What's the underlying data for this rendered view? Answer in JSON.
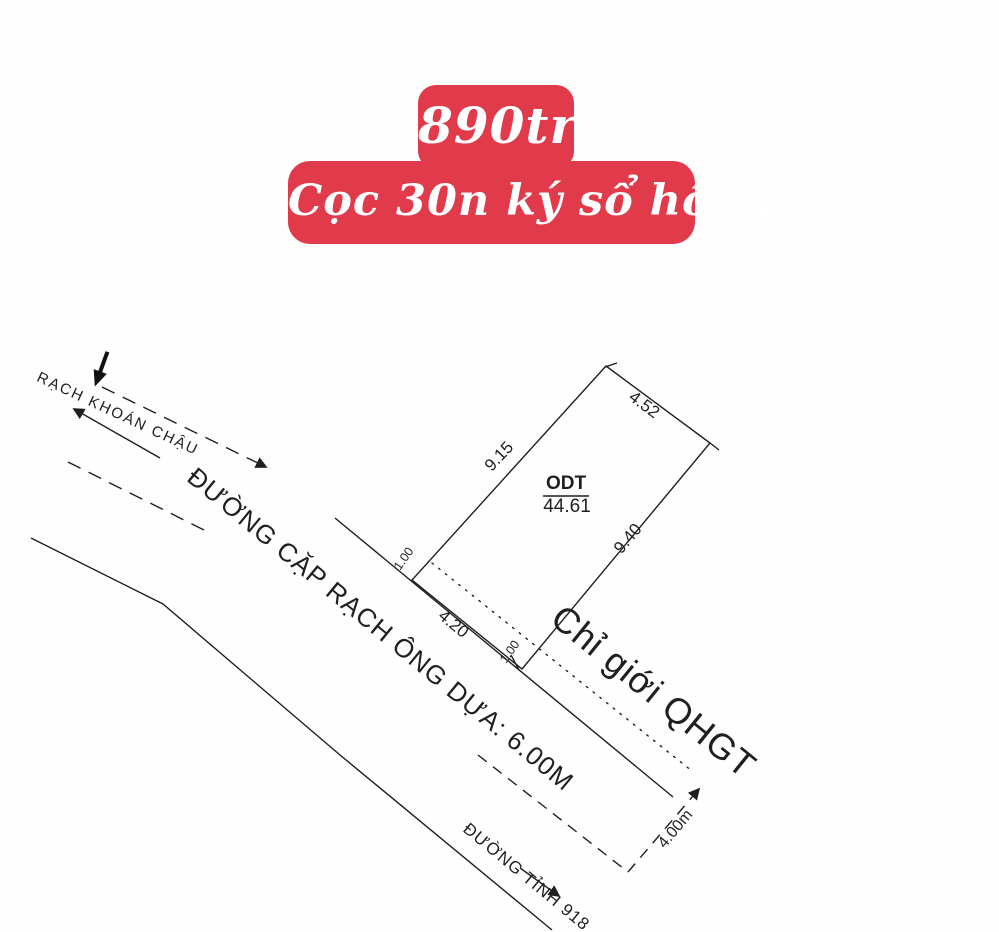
{
  "badge": {
    "price": "890tr",
    "deposit_line": "Cọc 30n ký sổ hồng",
    "bg_color": "#e03a4b",
    "text_color": "#ffffff"
  },
  "drawing": {
    "ink_color": "#1f1f1f",
    "labels": {
      "canal": "RẠCH KHOÁN CHẬU",
      "road_side": "ĐƯỜNG CẶP RẠCH ÔNG DỰA: 6.00M",
      "road_provincial": "ĐƯỜNG TỈNH 918",
      "planning_boundary": "Chỉ giới QHGT"
    },
    "parcel": {
      "land_use_code": "ODT",
      "area": "44.61",
      "edge_top": "4.52",
      "edge_left": "9.15",
      "edge_right": "9.40",
      "edge_front": "4.20",
      "setback_left": "1.00",
      "setback_right": "1.00",
      "boundary_width": "4.00m"
    }
  }
}
